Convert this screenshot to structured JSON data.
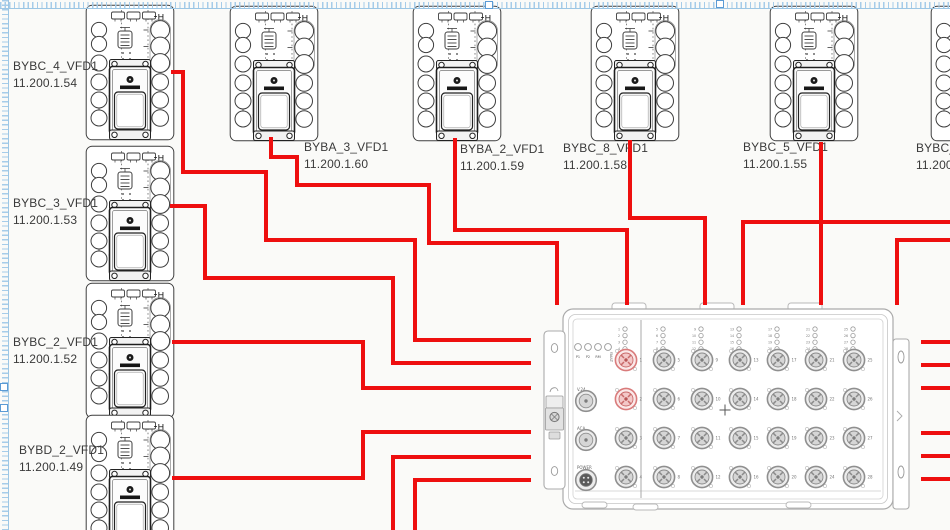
{
  "canvas": {
    "bg_color": "#fafaf8",
    "wire_color": "#ee0f0f",
    "guide_color": "#9cc6e4",
    "device_stroke": "#3e3e3e",
    "port_highlight": "#d97b7b"
  },
  "devices": [
    {
      "name": "BYBC_4_VFD1",
      "ip": "11.200.1.54",
      "x": 85,
      "y": 4,
      "label_x": 13,
      "label_y": 58
    },
    {
      "name": "BYBC_3_VFD1",
      "ip": "11.200.1.53",
      "x": 85,
      "y": 145,
      "label_x": 13,
      "label_y": 195
    },
    {
      "name": "BYBC_2_VFD1",
      "ip": "11.200.1.52",
      "x": 85,
      "y": 282,
      "label_x": 13,
      "label_y": 334
    },
    {
      "name": "BYBD_2_VFD1",
      "ip": "11.200.1.49",
      "x": 85,
      "y": 414,
      "label_x": 19,
      "label_y": 442
    },
    {
      "name": "BYBA_3_VFD1",
      "ip": "11.200.1.60",
      "x": 229,
      "y": 5,
      "label_x": 304,
      "label_y": 139
    },
    {
      "name": "BYBA_2_VFD1",
      "ip": "11.200.1.59",
      "x": 412,
      "y": 5,
      "label_x": 460,
      "label_y": 141
    },
    {
      "name": "BYBC_8_VFD1",
      "ip": "11.200.1.58",
      "x": 590,
      "y": 5,
      "label_x": 563,
      "label_y": 140
    },
    {
      "name": "BYBC_5_VFD1",
      "ip": "11.200.1.55",
      "x": 769,
      "y": 5,
      "label_x": 743,
      "label_y": 139
    },
    {
      "name": "BYBC_6_",
      "ip": "11.200.1",
      "x": 930,
      "y": 5,
      "label_x": 916,
      "label_y": 140
    }
  ],
  "switch": {
    "led_labels": [
      "P1",
      "P2",
      "RM",
      "FAULT"
    ],
    "labels": {
      "v24": "V.24",
      "aca": "ACA",
      "power": "POWER"
    },
    "port_count": 28,
    "highlighted_ports": [
      1,
      2
    ]
  },
  "connections": [
    {
      "id": "bybc4-to-switch",
      "points": [
        [
          171,
          72
        ],
        [
          183,
          72
        ],
        [
          183,
          172
        ],
        [
          266,
          172
        ],
        [
          266,
          240
        ],
        [
          415,
          240
        ],
        [
          415,
          340
        ],
        [
          531,
          340
        ]
      ]
    },
    {
      "id": "bybc3-to-switch",
      "points": [
        [
          170,
          206
        ],
        [
          205,
          206
        ],
        [
          205,
          278
        ],
        [
          393,
          278
        ],
        [
          393,
          363
        ],
        [
          531,
          363
        ]
      ]
    },
    {
      "id": "bybc2-to-switch",
      "points": [
        [
          172,
          342
        ],
        [
          363,
          342
        ],
        [
          363,
          388
        ],
        [
          531,
          388
        ]
      ]
    },
    {
      "id": "bybd2-to-switch",
      "points": [
        [
          172,
          478
        ],
        [
          363,
          478
        ],
        [
          363,
          432
        ],
        [
          531,
          432
        ]
      ]
    },
    {
      "id": "bottom-feed-1",
      "points": [
        [
          393,
          532
        ],
        [
          393,
          457
        ],
        [
          531,
          457
        ]
      ]
    },
    {
      "id": "bottom-feed-2",
      "points": [
        [
          415,
          532
        ],
        [
          415,
          480
        ],
        [
          531,
          480
        ]
      ]
    },
    {
      "id": "byba3-to-switch",
      "points": [
        [
          271,
          137
        ],
        [
          271,
          157
        ],
        [
          297,
          157
        ],
        [
          297,
          185
        ],
        [
          429,
          185
        ],
        [
          429,
          243
        ],
        [
          557,
          243
        ],
        [
          557,
          305
        ]
      ]
    },
    {
      "id": "byba2-to-switch",
      "points": [
        [
          455,
          138
        ],
        [
          455,
          230
        ],
        [
          627,
          230
        ],
        [
          627,
          305
        ]
      ]
    },
    {
      "id": "bybc8-to-switch",
      "points": [
        [
          630,
          140
        ],
        [
          630,
          218
        ],
        [
          705,
          218
        ],
        [
          705,
          305
        ]
      ]
    },
    {
      "id": "bybc5-to-switch",
      "points": [
        [
          821,
          142
        ],
        [
          821,
          305
        ]
      ]
    },
    {
      "id": "right-feed-1",
      "points": [
        [
          952,
          222
        ],
        [
          743,
          222
        ],
        [
          743,
          305
        ]
      ]
    },
    {
      "id": "right-feed-2",
      "points": [
        [
          952,
          240
        ],
        [
          897,
          240
        ],
        [
          897,
          305
        ]
      ]
    },
    {
      "id": "right-stub-1",
      "points": [
        [
          921,
          342
        ],
        [
          952,
          342
        ]
      ]
    },
    {
      "id": "right-stub-2",
      "points": [
        [
          921,
          365
        ],
        [
          952,
          365
        ]
      ]
    },
    {
      "id": "right-stub-3",
      "points": [
        [
          921,
          388
        ],
        [
          952,
          388
        ]
      ]
    },
    {
      "id": "right-stub-4",
      "points": [
        [
          921,
          433
        ],
        [
          952,
          433
        ]
      ]
    },
    {
      "id": "right-stub-5",
      "points": [
        [
          921,
          456
        ],
        [
          952,
          456
        ]
      ]
    },
    {
      "id": "right-stub-6",
      "points": [
        [
          921,
          479
        ],
        [
          952,
          479
        ]
      ]
    }
  ]
}
